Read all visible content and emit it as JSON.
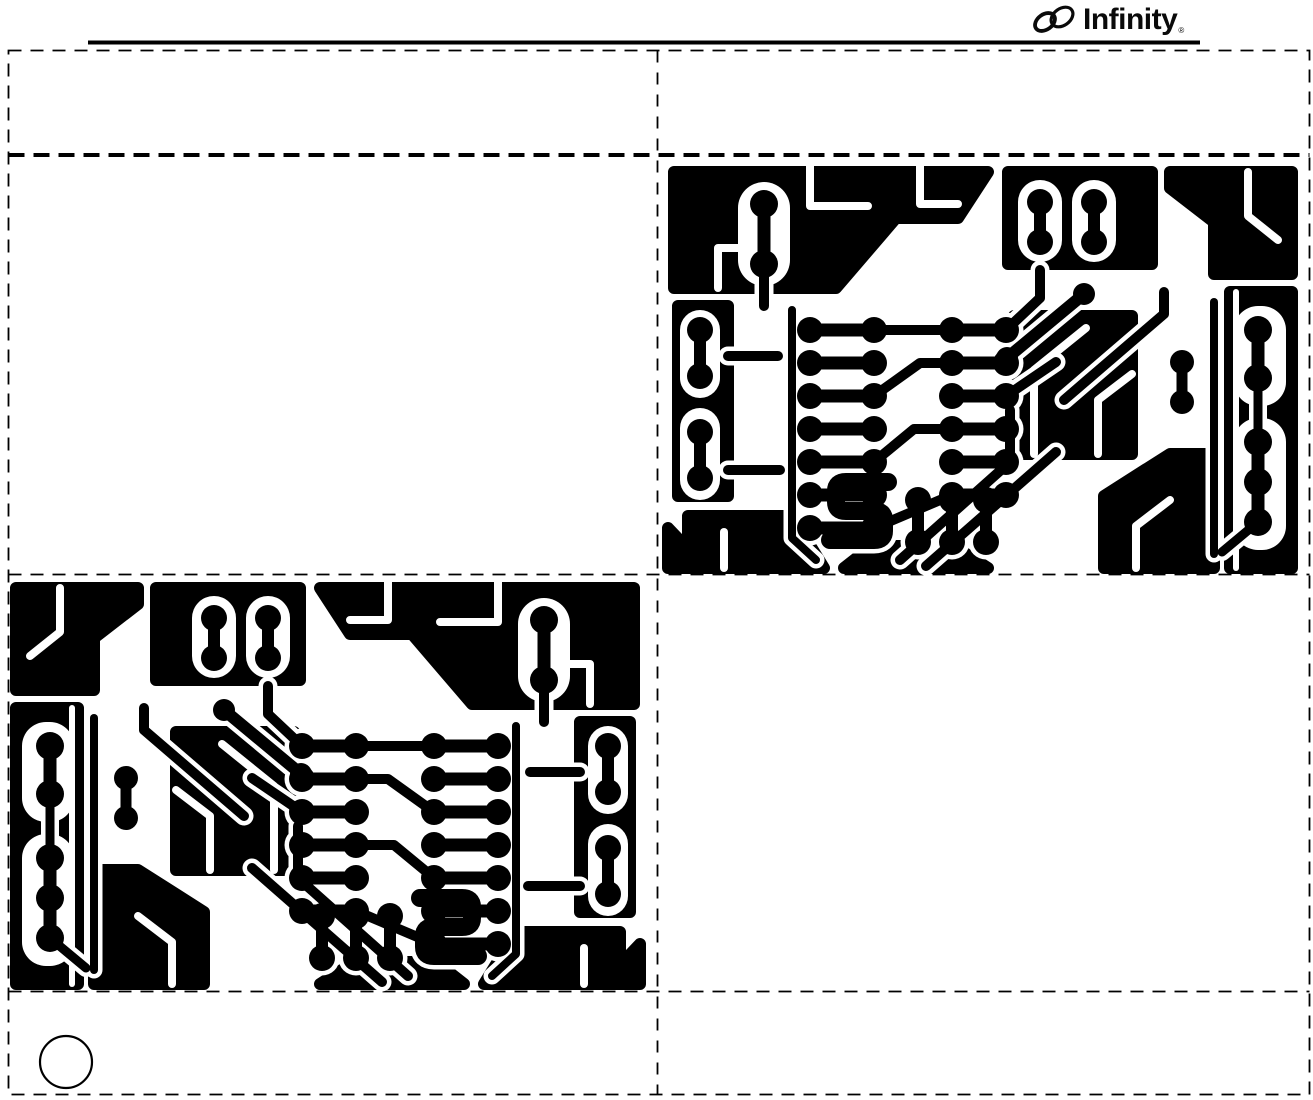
{
  "header": {
    "logo": {
      "text": "Infinity",
      "registered_mark": "®"
    }
  },
  "colors": {
    "ink": "#000000",
    "paper": "#ffffff"
  },
  "boards": {
    "top_right_label": "pcb-foil-pattern-top-right",
    "bottom_left_label": "pcb-foil-pattern-bottom-left"
  },
  "pcb": {
    "width": 642,
    "height": 414,
    "pour_stroke": 12,
    "halo": 9,
    "pours": [
      "M16,12 H330 L300,58 H238 L178,128 H16 Z",
      "M20,146 H70 V336 H20 Z",
      "M350,12 H494 V104 H350 Z",
      "M512,12 H634 V114 H556 V62 L512,28 Z",
      "M572,132 H634 V408 H572 Z",
      "M446,408 V336 L512,294 H556 V408 Z",
      "M30,408 V356 H134 L166,408 Z",
      "M356,156 H474 V294 H356 Z",
      "M186,408 L214,386 H296 L330,408 Z",
      "M10,408 V368 L48,408 Z"
    ],
    "cutouts": [
      [
        80,
        22,
        52,
        104,
        26
      ],
      [
        360,
        20,
        44,
        82,
        22
      ],
      [
        414,
        20,
        44,
        82,
        22
      ],
      [
        576,
        146,
        52,
        100,
        24
      ],
      [
        576,
        258,
        52,
        132,
        24
      ],
      [
        22,
        150,
        40,
        88,
        20
      ],
      [
        22,
        248,
        40,
        92,
        20
      ]
    ],
    "channels": [
      {
        "d": "M152,6 V46 H210",
        "w": 8
      },
      {
        "d": "M262,6 V44 H300",
        "w": 8
      },
      {
        "d": "M60,128 V88 H108",
        "w": 8
      },
      {
        "d": "M590,12 V56 L620,80",
        "w": 8
      },
      {
        "d": "M578,132 V408",
        "w": 6
      },
      {
        "d": "M376,294 V210 L428,168",
        "w": 8
      },
      {
        "d": "M440,294 V240 L474,214",
        "w": 8
      },
      {
        "d": "M478,408 V366 L512,340",
        "w": 8
      },
      {
        "d": "M66,408 V372",
        "w": 8
      }
    ],
    "traces": [
      {
        "d": "M230,322 H188 Q178,322 178,331 V342 Q178,351 188,351 H216 Q226,351 226,360 V371 Q226,380 216,380 H172",
        "w": 18
      },
      {
        "d": "M216,170 H294",
        "w": 10
      },
      {
        "d": "M216,236 L262,203 H294",
        "w": 10
      },
      {
        "d": "M216,302 L256,269 H294",
        "w": 10
      },
      {
        "d": "M216,368 L294,335",
        "w": 10
      },
      {
        "d": "M106,104 V146",
        "w": 10
      },
      {
        "d": "M348,170 L382,138 V110",
        "w": 10
      },
      {
        "d": "M348,236 L398,202",
        "w": 10
      },
      {
        "d": "M242,400 L352,302 V250",
        "w": 10
      },
      {
        "d": "M268,406 L398,292",
        "w": 10
      },
      {
        "d": "M406,240 L506,154 V132",
        "w": 10
      },
      {
        "d": "M349,198 L426,134",
        "w": 12
      },
      {
        "d": "M70,196 H120",
        "w": 10
      },
      {
        "d": "M70,310 H122",
        "w": 10
      },
      {
        "d": "M556,142 V394",
        "w": 8
      },
      {
        "d": "M600,218 V282",
        "w": 9
      },
      {
        "d": "M600,362 L564,392",
        "w": 9
      },
      {
        "d": "M134,150 V378 L158,400",
        "w": 8
      }
    ],
    "pads": [
      {
        "pts": [
          [
            106,
            44
          ],
          [
            106,
            104
          ]
        ],
        "r": 14,
        "w": 13
      },
      {
        "pts": [
          [
            382,
            42
          ],
          [
            382,
            82
          ]
        ],
        "r": 13,
        "w": 12
      },
      {
        "pts": [
          [
            436,
            42
          ],
          [
            436,
            82
          ]
        ],
        "r": 13,
        "w": 12
      },
      {
        "pts": [
          [
            600,
            170
          ],
          [
            600,
            218
          ]
        ],
        "r": 14,
        "w": 13
      },
      {
        "pts": [
          [
            600,
            282
          ],
          [
            600,
            322
          ],
          [
            600,
            362
          ]
        ],
        "r": 14,
        "w": 13
      },
      {
        "pts": [
          [
            42,
            170
          ],
          [
            42,
            216
          ]
        ],
        "r": 13,
        "w": 12
      },
      {
        "pts": [
          [
            42,
            272
          ],
          [
            42,
            318
          ]
        ],
        "r": 13,
        "w": 12
      },
      {
        "pts": [
          [
            152,
            170
          ],
          [
            216,
            170
          ]
        ],
        "r": 13,
        "w": 13
      },
      {
        "pts": [
          [
            152,
            203
          ],
          [
            216,
            203
          ]
        ],
        "r": 13,
        "w": 13
      },
      {
        "pts": [
          [
            152,
            236
          ],
          [
            216,
            236
          ]
        ],
        "r": 13,
        "w": 13
      },
      {
        "pts": [
          [
            152,
            269
          ],
          [
            216,
            269
          ]
        ],
        "r": 13,
        "w": 13
      },
      {
        "pts": [
          [
            152,
            302
          ],
          [
            216,
            302
          ]
        ],
        "r": 13,
        "w": 13
      },
      {
        "pts": [
          [
            152,
            335
          ],
          [
            216,
            335
          ]
        ],
        "r": 13,
        "w": 13
      },
      {
        "pts": [
          [
            152,
            368
          ],
          [
            216,
            368
          ]
        ],
        "r": 13,
        "w": 13
      },
      {
        "pts": [
          [
            294,
            170
          ],
          [
            348,
            170
          ]
        ],
        "r": 13,
        "w": 13
      },
      {
        "pts": [
          [
            294,
            203
          ],
          [
            348,
            203
          ]
        ],
        "r": 13,
        "w": 13
      },
      {
        "pts": [
          [
            294,
            236
          ],
          [
            348,
            236
          ]
        ],
        "r": 13,
        "w": 13
      },
      {
        "pts": [
          [
            294,
            269
          ],
          [
            348,
            269
          ]
        ],
        "r": 13,
        "w": 13
      },
      {
        "pts": [
          [
            294,
            302
          ],
          [
            348,
            302
          ]
        ],
        "r": 13,
        "w": 13
      },
      {
        "pts": [
          [
            294,
            335
          ],
          [
            348,
            335
          ]
        ],
        "r": 13,
        "w": 13
      },
      {
        "pts": [
          [
            260,
            340
          ],
          [
            260,
            382
          ]
        ],
        "r": 13,
        "w": 12
      },
      {
        "pts": [
          [
            294,
            340
          ],
          [
            294,
            382
          ]
        ],
        "r": 13,
        "w": 12
      },
      {
        "pts": [
          [
            328,
            340
          ],
          [
            328,
            382
          ]
        ],
        "r": 13,
        "w": 12
      },
      {
        "pts": [
          [
            524,
            202
          ],
          [
            524,
            242
          ]
        ],
        "r": 12,
        "w": 11
      },
      {
        "pts": [
          [
            349,
            198
          ]
        ],
        "r": 11,
        "w": 0
      },
      {
        "pts": [
          [
            426,
            134
          ]
        ],
        "r": 11,
        "w": 0
      }
    ]
  }
}
